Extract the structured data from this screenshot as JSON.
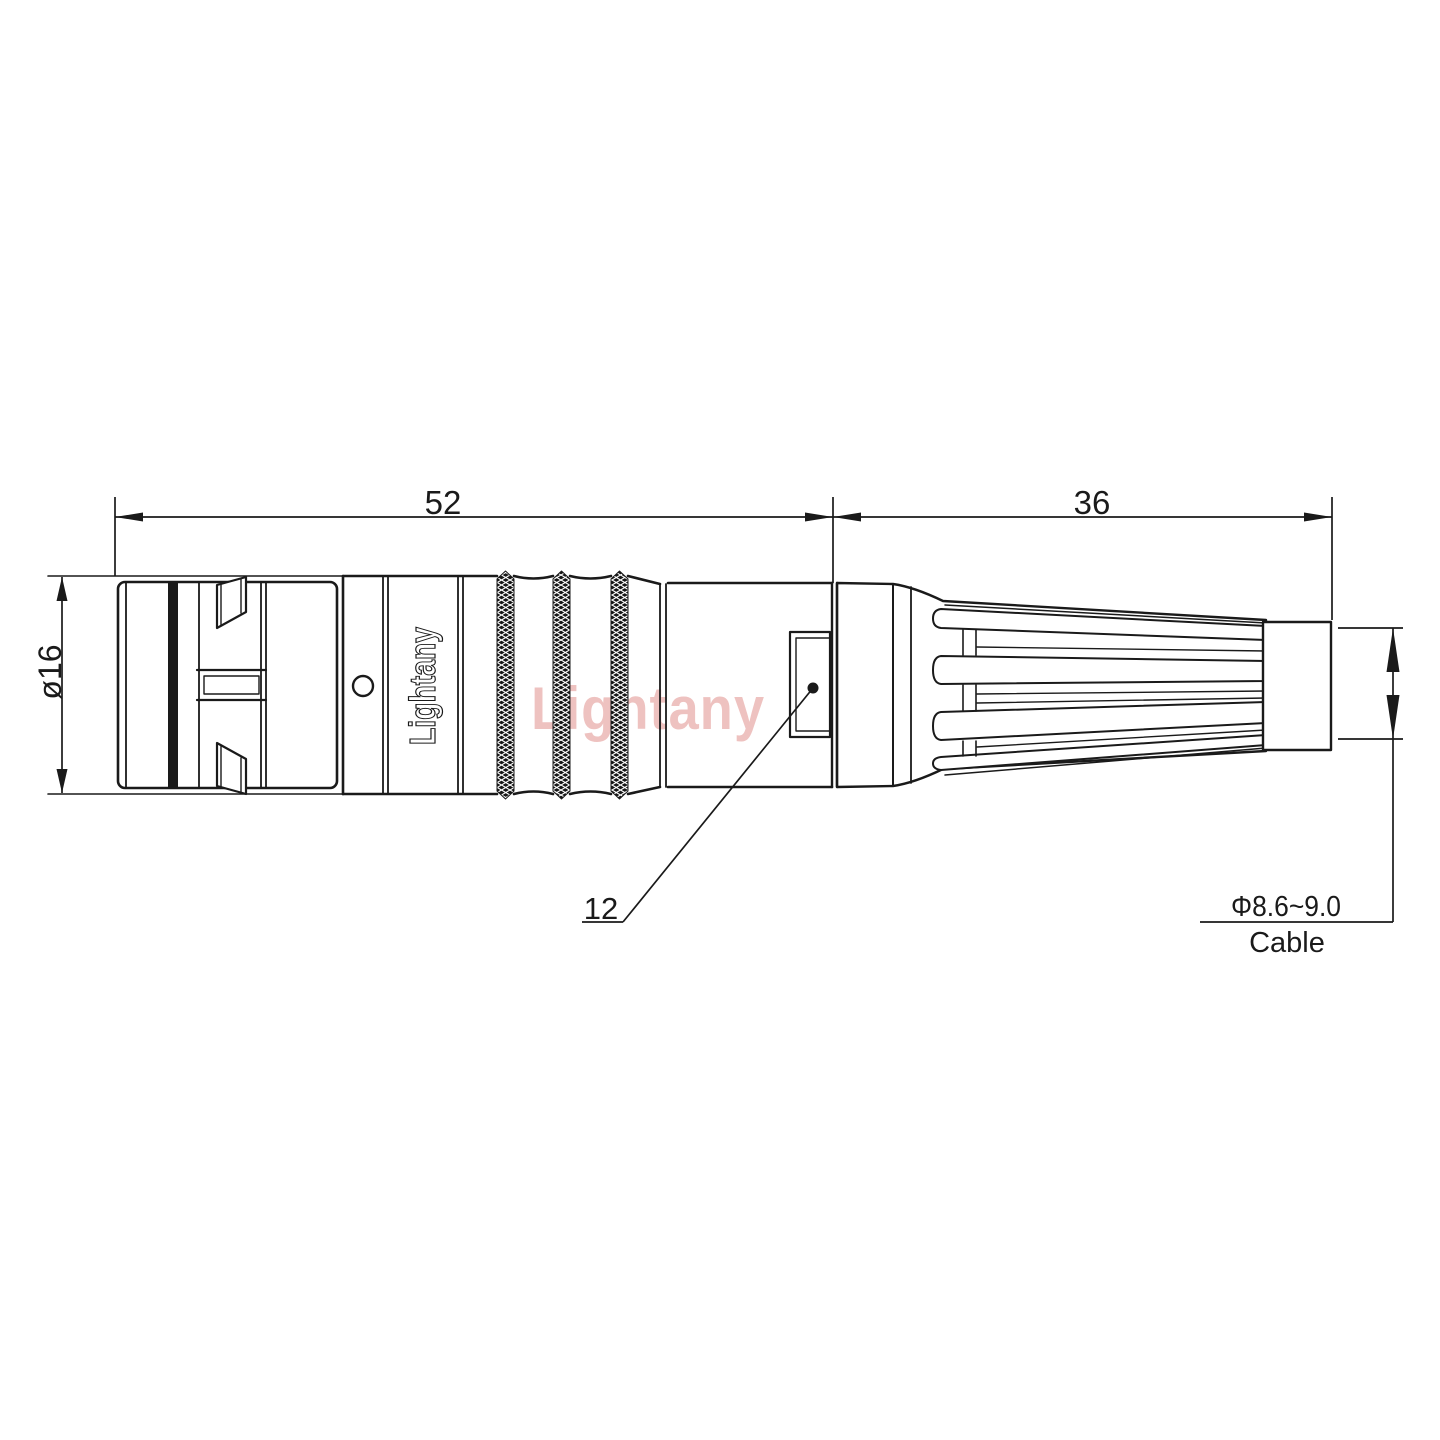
{
  "drawing": {
    "type": "technical-drawing-side-view",
    "subject": "circular push-pull cable connector",
    "dimensions": {
      "body_length": "52",
      "boot_length": "36",
      "body_diameter": "ø16",
      "nut_flat": "12",
      "cable_diameter_range": "Φ8.6~9.0",
      "cable_label": "Cable"
    },
    "brand_engraving": "Lightany",
    "watermark": "Lightany",
    "colors": {
      "line": "#1a1a1a",
      "watermark": "#d96f6a",
      "background": "#ffffff"
    }
  }
}
